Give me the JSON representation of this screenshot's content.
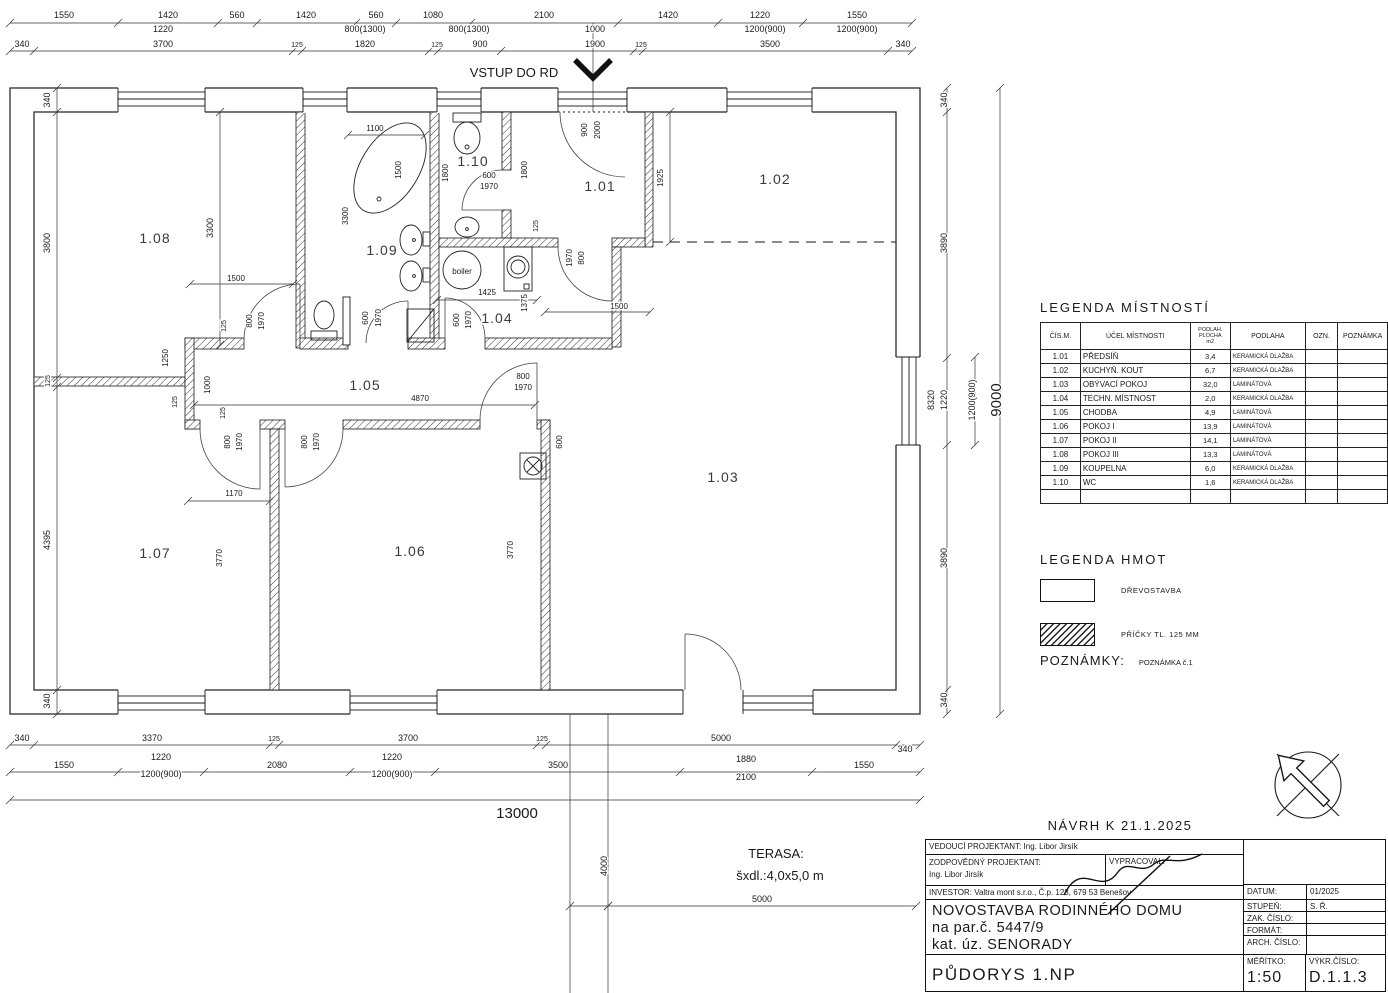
{
  "plan_texts": [
    {
      "t": "1550",
      "x": 64,
      "y": 18
    },
    {
      "t": "1420",
      "x": 168,
      "y": 18
    },
    {
      "t": "560",
      "x": 237,
      "y": 18
    },
    {
      "t": "1420",
      "x": 306,
      "y": 18
    },
    {
      "t": "560",
      "x": 376,
      "y": 18
    },
    {
      "t": "1080",
      "x": 433,
      "y": 18
    },
    {
      "t": "2100",
      "x": 544,
      "y": 18
    },
    {
      "t": "1420",
      "x": 668,
      "y": 18
    },
    {
      "t": "1220",
      "x": 760,
      "y": 18
    },
    {
      "t": "1550",
      "x": 857,
      "y": 18
    },
    {
      "t": "1220",
      "x": 163,
      "y": 32
    },
    {
      "t": "800(1300)",
      "x": 365,
      "y": 32
    },
    {
      "t": "800(1300)",
      "x": 469,
      "y": 32
    },
    {
      "t": "1000",
      "x": 595,
      "y": 32
    },
    {
      "t": "1200(900)",
      "x": 765,
      "y": 32
    },
    {
      "t": "1200(900)",
      "x": 857,
      "y": 32
    },
    {
      "t": "340",
      "x": 22,
      "y": 47
    },
    {
      "t": "3700",
      "x": 163,
      "y": 47
    },
    {
      "t": "125",
      "x": 297,
      "y": 47,
      "s": 7
    },
    {
      "t": "1820",
      "x": 365,
      "y": 47
    },
    {
      "t": "125",
      "x": 437,
      "y": 47,
      "s": 7
    },
    {
      "t": "900",
      "x": 480,
      "y": 47
    },
    {
      "t": "1900",
      "x": 595,
      "y": 47
    },
    {
      "t": "125",
      "x": 641,
      "y": 47,
      "s": 7
    },
    {
      "t": "3500",
      "x": 770,
      "y": 47
    },
    {
      "t": "340",
      "x": 903,
      "y": 47
    },
    {
      "t": "VSTUP DO RD",
      "x": 514,
      "y": 77,
      "s": 13,
      "n": "entry-label"
    },
    {
      "t": "340",
      "x": 50,
      "y": 100,
      "r": 1
    },
    {
      "t": "3800",
      "x": 50,
      "y": 243,
      "r": 1
    },
    {
      "t": "125",
      "x": 50,
      "y": 381,
      "r": 1,
      "s": 7
    },
    {
      "t": "4395",
      "x": 50,
      "y": 540,
      "r": 1
    },
    {
      "t": "340",
      "x": 50,
      "y": 701,
      "r": 1
    },
    {
      "t": "3300",
      "x": 213,
      "y": 228,
      "r": 1
    },
    {
      "t": "340",
      "x": 947,
      "y": 100,
      "r": 1
    },
    {
      "t": "3890",
      "x": 947,
      "y": 243,
      "r": 1
    },
    {
      "t": "8320",
      "x": 934,
      "y": 400,
      "r": 1
    },
    {
      "t": "1220",
      "x": 947,
      "y": 400,
      "r": 1
    },
    {
      "t": "3890",
      "x": 947,
      "y": 558,
      "r": 1
    },
    {
      "t": "340",
      "x": 947,
      "y": 700,
      "r": 1
    },
    {
      "t": "1200(900)",
      "x": 975,
      "y": 400,
      "r": 1
    },
    {
      "t": "9000",
      "x": 1001,
      "y": 400,
      "r": 1,
      "s": 15
    },
    {
      "t": "340",
      "x": 22,
      "y": 741
    },
    {
      "t": "3370",
      "x": 152,
      "y": 741
    },
    {
      "t": "125",
      "x": 274,
      "y": 741,
      "s": 7
    },
    {
      "t": "3700",
      "x": 408,
      "y": 741
    },
    {
      "t": "125",
      "x": 542,
      "y": 741,
      "s": 7
    },
    {
      "t": "5000",
      "x": 721,
      "y": 741
    },
    {
      "t": "340",
      "x": 905,
      "y": 752
    },
    {
      "t": "1550",
      "x": 64,
      "y": 768
    },
    {
      "t": "1220",
      "x": 161,
      "y": 760
    },
    {
      "t": "1200(900)",
      "x": 161,
      "y": 777
    },
    {
      "t": "2080",
      "x": 277,
      "y": 768
    },
    {
      "t": "1220",
      "x": 392,
      "y": 760
    },
    {
      "t": "1200(900)",
      "x": 392,
      "y": 777
    },
    {
      "t": "3500",
      "x": 558,
      "y": 768
    },
    {
      "t": "1880",
      "x": 746,
      "y": 762
    },
    {
      "t": "2100",
      "x": 746,
      "y": 780
    },
    {
      "t": "1550",
      "x": 864,
      "y": 768
    },
    {
      "t": "13000",
      "x": 517,
      "y": 818,
      "s": 15
    },
    {
      "t": "4000",
      "x": 607,
      "y": 866,
      "r": 1
    },
    {
      "t": "5000",
      "x": 762,
      "y": 902
    },
    {
      "t": "TERASA:",
      "x": 776,
      "y": 858,
      "s": 13,
      "n": "terasa-label"
    },
    {
      "t": "šxdl.:4,0x5,0 m",
      "x": 780,
      "y": 880,
      "s": 13,
      "n": "terasa-size"
    },
    {
      "t": "1100",
      "x": 375,
      "y": 131,
      "s": 8
    },
    {
      "t": "1500",
      "x": 401,
      "y": 170,
      "r": 1,
      "s": 8
    },
    {
      "t": "3300",
      "x": 348,
      "y": 216,
      "r": 1,
      "s": 8
    },
    {
      "t": "1800",
      "x": 448,
      "y": 173,
      "r": 1,
      "s": 8
    },
    {
      "t": "1800",
      "x": 527,
      "y": 170,
      "r": 1,
      "s": 8
    },
    {
      "t": "600",
      "x": 489,
      "y": 178,
      "s": 8
    },
    {
      "t": "1970",
      "x": 489,
      "y": 189,
      "s": 8
    },
    {
      "t": "900",
      "x": 587,
      "y": 130,
      "r": 1,
      "s": 8
    },
    {
      "t": "2000",
      "x": 600,
      "y": 130,
      "r": 1,
      "s": 8
    },
    {
      "t": "125",
      "x": 538,
      "y": 226,
      "r": 1,
      "s": 7
    },
    {
      "t": "1970",
      "x": 572,
      "y": 258,
      "r": 1,
      "s": 8
    },
    {
      "t": "800",
      "x": 584,
      "y": 258,
      "r": 1,
      "s": 8
    },
    {
      "t": "1500",
      "x": 619,
      "y": 309,
      "s": 8
    },
    {
      "t": "1425",
      "x": 487,
      "y": 295,
      "s": 8
    },
    {
      "t": "1375",
      "x": 527,
      "y": 303,
      "r": 1,
      "s": 8
    },
    {
      "t": "600",
      "x": 459,
      "y": 320,
      "r": 1,
      "s": 8
    },
    {
      "t": "1970",
      "x": 471,
      "y": 320,
      "r": 1,
      "s": 8
    },
    {
      "t": "600",
      "x": 368,
      "y": 318,
      "r": 1,
      "s": 8
    },
    {
      "t": "1970",
      "x": 381,
      "y": 318,
      "r": 1,
      "s": 8
    },
    {
      "t": "125",
      "x": 226,
      "y": 326,
      "r": 1,
      "s": 7
    },
    {
      "t": "800",
      "x": 252,
      "y": 321,
      "r": 1,
      "s": 8
    },
    {
      "t": "1970",
      "x": 264,
      "y": 321,
      "r": 1,
      "s": 8
    },
    {
      "t": "1500",
      "x": 236,
      "y": 281,
      "s": 8
    },
    {
      "t": "1250",
      "x": 168,
      "y": 358,
      "r": 1,
      "s": 8
    },
    {
      "t": "1000",
      "x": 210,
      "y": 385,
      "r": 1,
      "s": 8
    },
    {
      "t": "125",
      "x": 177,
      "y": 402,
      "r": 1,
      "s": 7
    },
    {
      "t": "125",
      "x": 225,
      "y": 413,
      "r": 1,
      "s": 7
    },
    {
      "t": "4870",
      "x": 420,
      "y": 401,
      "s": 8
    },
    {
      "t": "800",
      "x": 523,
      "y": 379,
      "s": 8
    },
    {
      "t": "1970",
      "x": 523,
      "y": 390,
      "s": 8
    },
    {
      "t": "800",
      "x": 230,
      "y": 442,
      "r": 1,
      "s": 8
    },
    {
      "t": "1970",
      "x": 242,
      "y": 442,
      "r": 1,
      "s": 8
    },
    {
      "t": "800",
      "x": 307,
      "y": 442,
      "r": 1,
      "s": 8
    },
    {
      "t": "1970",
      "x": 319,
      "y": 442,
      "r": 1,
      "s": 8
    },
    {
      "t": "1170",
      "x": 234,
      "y": 496,
      "s": 8
    },
    {
      "t": "3770",
      "x": 222,
      "y": 558,
      "r": 1,
      "s": 8
    },
    {
      "t": "3770",
      "x": 513,
      "y": 550,
      "r": 1,
      "s": 8
    },
    {
      "t": "600",
      "x": 562,
      "y": 442,
      "r": 1,
      "s": 8
    },
    {
      "t": "1925",
      "x": 663,
      "y": 178,
      "r": 1,
      "s": 8
    },
    {
      "t": "boiler",
      "x": 462,
      "y": 274,
      "s": 8,
      "n": "boiler-label"
    }
  ],
  "rooms": [
    {
      "id": "1.01",
      "x": 600,
      "y": 191
    },
    {
      "id": "1.02",
      "x": 775,
      "y": 184
    },
    {
      "id": "1.03",
      "x": 723,
      "y": 482
    },
    {
      "id": "1.04",
      "x": 497,
      "y": 323
    },
    {
      "id": "1.05",
      "x": 365,
      "y": 390
    },
    {
      "id": "1.06",
      "x": 410,
      "y": 556
    },
    {
      "id": "1.07",
      "x": 155,
      "y": 558
    },
    {
      "id": "1.08",
      "x": 155,
      "y": 243
    },
    {
      "id": "1.09",
      "x": 382,
      "y": 255
    },
    {
      "id": "1.10",
      "x": 473,
      "y": 166
    }
  ],
  "legend_rooms": {
    "title": "LEGENDA MÍSTNOSTÍ",
    "headers": [
      "ČÍS.M.",
      "ÚČEL MÍSTNOSTI",
      "PODLAH.|PLOCHA|m2",
      "PODLAHA",
      "OZN.",
      "POZNÁMKA"
    ],
    "rows": [
      [
        "1.01",
        "PŘEDSÍŇ",
        "3,4",
        "KERAMICKÁ DLAŽBA",
        "",
        ""
      ],
      [
        "1.02",
        "KUCHYŇ. KOUT",
        "6,7",
        "KERAMICKÁ DLAŽBA",
        "",
        ""
      ],
      [
        "1.03",
        "OBÝVACÍ POKOJ",
        "32,0",
        "LAMINÁTOVÁ",
        "",
        ""
      ],
      [
        "1.04",
        "TECHN. MÍSTNOST",
        "2,0",
        "KERAMICKÁ DLAŽBA",
        "",
        ""
      ],
      [
        "1.05",
        "CHODBA",
        "4,9",
        "LAMINÁTOVÁ",
        "",
        ""
      ],
      [
        "1.06",
        "POKOJ I",
        "13,9",
        "LAMINÁTOVÁ",
        "",
        ""
      ],
      [
        "1.07",
        "POKOJ II",
        "14,1",
        "LAMINÁTOVÁ",
        "",
        ""
      ],
      [
        "1.08",
        "POKOJ III",
        "13,3",
        "LAMINÁTOVÁ",
        "",
        ""
      ],
      [
        "1.09",
        "KOUPELNA",
        "6,0",
        "KERAMICKÁ DLAŽBA",
        "",
        ""
      ],
      [
        "1.10",
        "WC",
        "1,6",
        "KERAMICKÁ DLAŽBA",
        "",
        ""
      ],
      [
        "",
        "",
        "",
        "",
        "",
        ""
      ]
    ]
  },
  "legend_hmot": {
    "title": "LEGENDA HMOT",
    "items": [
      {
        "label": "DŘEVOSTAVBA",
        "hatch": false
      },
      {
        "label": "PŘÍČKY TL. 125 MM",
        "hatch": true
      }
    ]
  },
  "poznamky": {
    "label": "POZNÁMKY:",
    "note": "POZNÁMKA č.1"
  },
  "titleblock": {
    "navrh": "NÁVRH K 21.1.2025",
    "vedouci": "VEDOUCÍ PROJEKTANT: Ing. Libor Jirsík",
    "zodpovedny_label": "ZODPOVĚDNÝ PROJEKTANT:",
    "zodpovedny_name": "Ing. Libor Jirsík",
    "vypracoval_label": "VYPRACOVAL:",
    "investor": "INVESTOR: Valtra mont s.r.o., Č.p. 123, 679 53 Benešov",
    "title1": "NOVOSTAVBA RODINNÉHO DOMU",
    "title2": "na par.č. 5447/9",
    "title3": "kat. úz. SENORADY",
    "drawing_name": "PŮDORYS 1.NP",
    "datum_label": "DATUM:",
    "datum": "01/2025",
    "stupen_label": "STUPEŇ:",
    "stupen": "S. Ř.",
    "zak_label": "ZAK. ČÍSLO:",
    "zak": "",
    "format_label": "FORMÁT:",
    "format": "",
    "arch_label": "ARCH. ČÍSLO:",
    "arch": "",
    "meritko_label": "MĚŘÍTKO:",
    "meritko": "1:50",
    "vykres_label": "VÝKR.ČÍSLO:",
    "vykres": "D.1.1.3"
  }
}
